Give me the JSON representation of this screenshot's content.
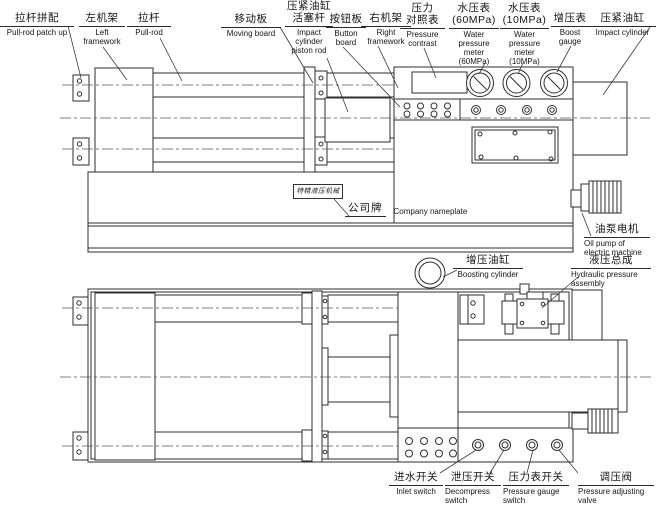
{
  "page": {
    "background": "#ffffff",
    "line_color": "#2e2e2e"
  },
  "nameplate": {
    "text": "特精液压机械厂"
  },
  "labels": {
    "pull_rod_patch_up": {
      "zh": "拉杆拼配",
      "en": "Pull-rod patch up"
    },
    "left_framework": {
      "zh": "左机架",
      "en": "Left\nframework"
    },
    "pull_rod": {
      "zh": "拉杆",
      "en": "Pull-rod"
    },
    "moving_board": {
      "zh": "移动板",
      "en": "Moving board"
    },
    "impact_cylinder_piston_rod": {
      "zh": "压紧油缸\n活塞杆",
      "en": "Impact\ncylinder\npiston rod"
    },
    "button_board": {
      "zh": "按钮板",
      "en": "Button\nboard"
    },
    "right_framework": {
      "zh": "右机架",
      "en": "Right\nframework"
    },
    "pressure_contrast": {
      "zh": "压力\n对照表",
      "en": "Pressure\ncontrast"
    },
    "water_pressure_meter_60": {
      "zh": "水压表\n(60MPa)",
      "en": "Water\npressure\nmeter\n(60MPa)"
    },
    "water_pressure_meter_10": {
      "zh": "水压表\n(10MPa)",
      "en": "Water\npressure\nmeter\n(10MPa)"
    },
    "boost_gauge": {
      "zh": "增压表",
      "en": "Boost\ngauge"
    },
    "impact_cylinder": {
      "zh": "压紧油缸",
      "en": "Impact cylinder"
    },
    "company_nameplate": {
      "zh": "公司牌",
      "en": "Company nameplate"
    },
    "oil_pump": {
      "zh": "油泵电机",
      "en": "Oil pump of\nelectric machine"
    },
    "hydraulic_assembly": {
      "zh": "液压总成",
      "en": "Hydraulic pressure\nassembly"
    },
    "boosting_cylinder": {
      "zh": "增压油缸",
      "en": "Boosting cylinder"
    },
    "inlet_switch": {
      "zh": "进水开关",
      "en": "Inlet switch"
    },
    "decompress_switch": {
      "zh": "泄压开关",
      "en": "Decompress\nswitch"
    },
    "pressure_gauge_switch": {
      "zh": "压力表开关",
      "en": "Pressure gauge\nswitch"
    },
    "pressure_adjusting_valve": {
      "zh": "调压阀",
      "en": "Pressure adjusting\nvalve"
    }
  }
}
